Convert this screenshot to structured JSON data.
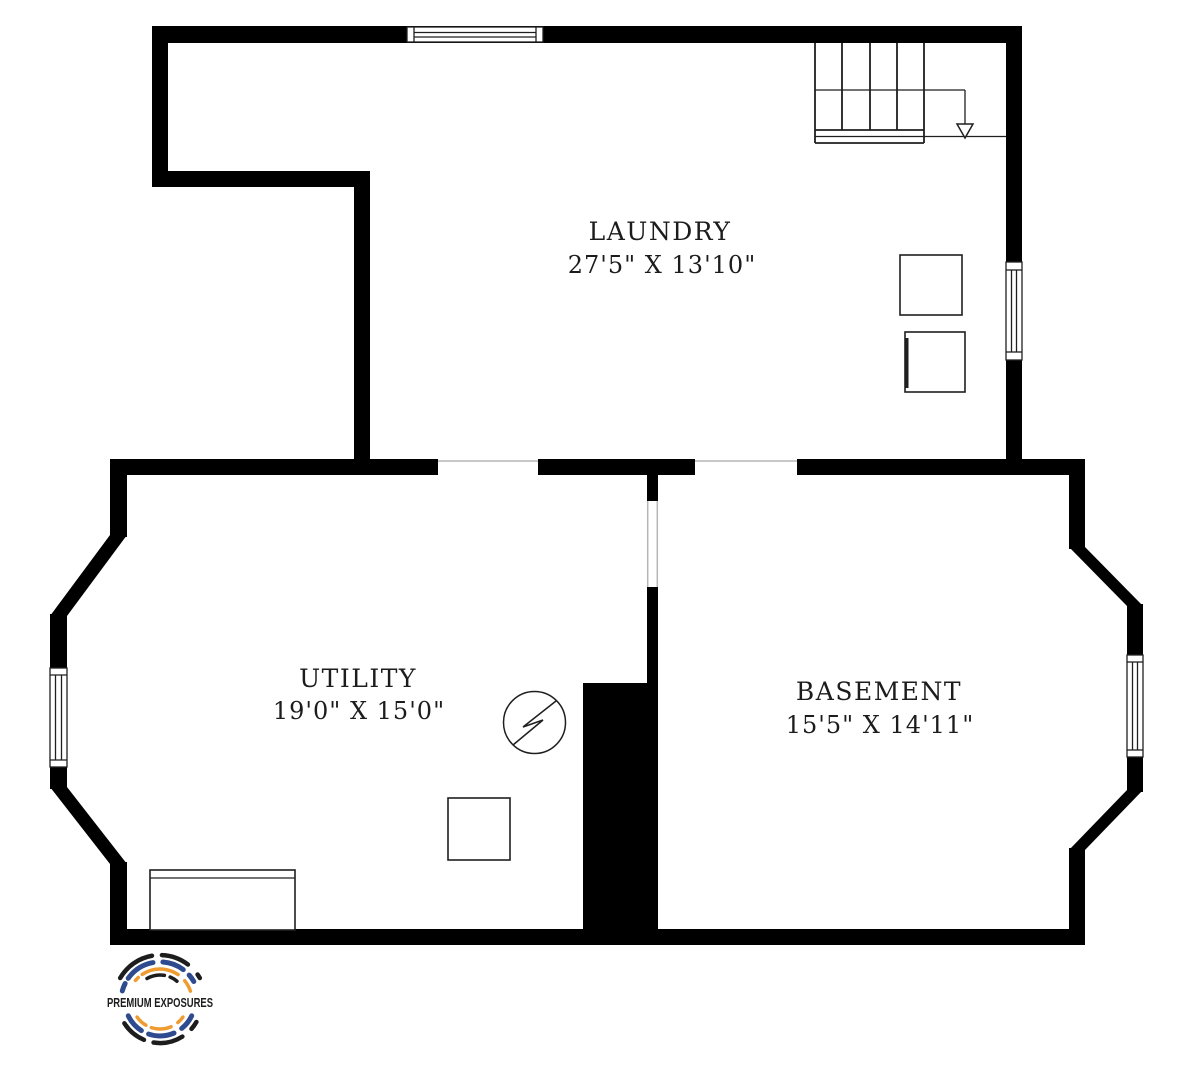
{
  "canvas": {
    "width": 1203,
    "height": 1080,
    "background": "#ffffff"
  },
  "rooms": {
    "laundry": {
      "name": "LAUNDRY",
      "dims": "27'5\" X 13'10\""
    },
    "utility": {
      "name": "UTILITY",
      "dims": "19'0\" X 15'0\""
    },
    "basement": {
      "name": "BASEMENT",
      "dims": "15'5\" X 14'11\""
    }
  },
  "colors": {
    "wall": "#000000",
    "line": "#1f1f1f",
    "opening": "#b5b5b5",
    "label": "#1c1c1c"
  },
  "logo": {
    "text": "PREMIUM EXPOSURES",
    "navy": "#2d4b8e",
    "orange": "#ef9b30",
    "dark": "#1d1d1d"
  }
}
